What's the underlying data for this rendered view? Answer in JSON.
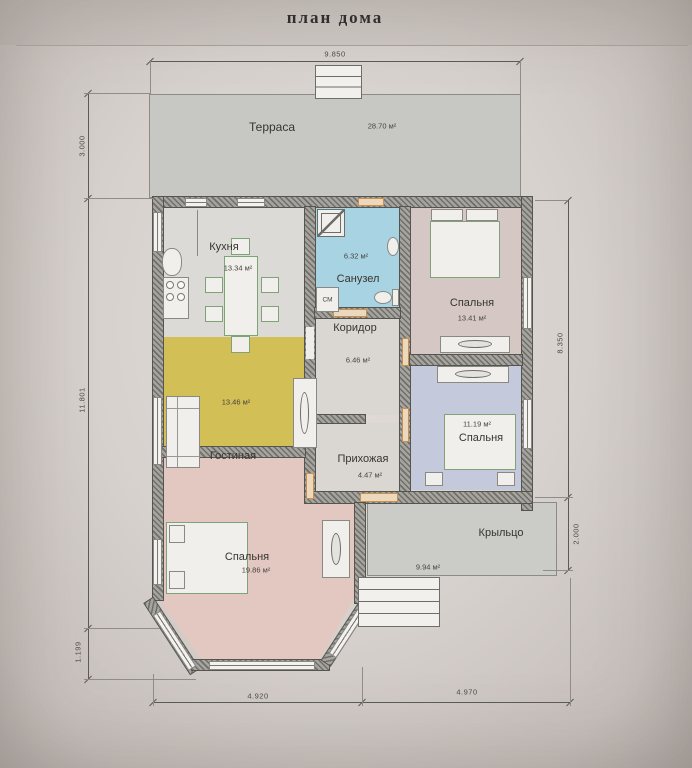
{
  "title": "план дома",
  "rooms": {
    "terrace": {
      "name": "Терраса",
      "area": "28.70 м²"
    },
    "kitchen": {
      "name": "Кухня",
      "area": "13.34 м²"
    },
    "bathroom": {
      "name": "Санузел",
      "area": "6.32 м²"
    },
    "corridor": {
      "name": "Коридор",
      "area": "6.46 м²"
    },
    "bedroom_top": {
      "name": "Спальня",
      "area": "13.41 м²"
    },
    "living": {
      "name": "Гостиная",
      "area": "13.46 м²"
    },
    "hallway": {
      "name": "Прихожая",
      "area": "4.47 м²"
    },
    "bedroom_right": {
      "name": "Спальня",
      "area": "11.19 м²"
    },
    "bedroom_left": {
      "name": "Спальня",
      "area": "19.86 м²"
    },
    "porch": {
      "name": "Крыльцо",
      "area": "9.94 м²"
    }
  },
  "appliances": {
    "washing_machine": "СМ"
  },
  "dimensions": {
    "top_width": "9.850",
    "terrace_depth": "3.000",
    "house_depth": "11.801",
    "bay_depth": "1.199",
    "bottom_left_width": "4.920",
    "bottom_right_width": "4.970",
    "right_depth": "8.350",
    "porch_depth": "2.000"
  },
  "colors": {
    "living_room_fill": "#d2bf55",
    "bathroom_fill": "#a8d3e2",
    "bedroom_left_fill": "#e2c8c0",
    "bedroom_right_fill": "#c4cadb",
    "bedroom_top_fill": "#d5c8c4",
    "kitchen_fill": "#dcdad6",
    "terrace_fill": "#c7c7c3",
    "porch_fill": "#cbcbc7",
    "wall_fill": "#a6a49e",
    "door_accent": "#c98f4f"
  }
}
